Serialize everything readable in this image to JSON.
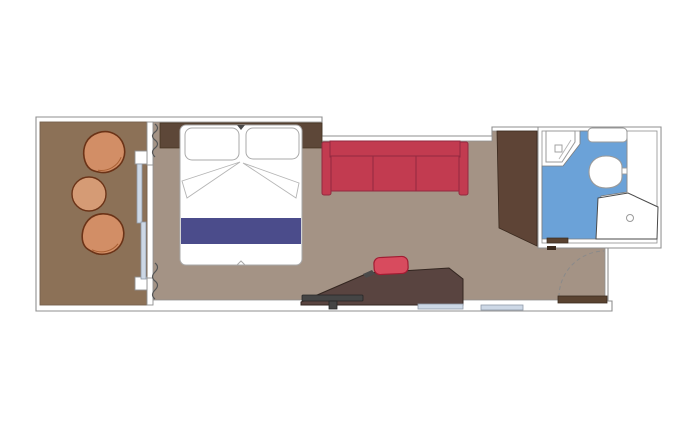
{
  "palette": {
    "background": "#ffffff",
    "wall_fill": "#ffffff",
    "wall_outline": "#8f8f8f",
    "balcony_floor": "#8c7157",
    "balcony_floor_edge": "#75604c",
    "room_floor": "#a49385",
    "floor_edge": "#8f8f8f",
    "chair": "#d28e66",
    "chair_outline": "#6b3317",
    "chair_rim": "#a85f33",
    "table": "#d59b75",
    "headboard_wood": "#5d4738",
    "headboard_edge": "#42311f",
    "wardrobe": "#5e4436",
    "wardrobe_outline": "#39291e",
    "bed_fill": "#ffffff",
    "bed_outline": "#a9a9a9",
    "fold_line": "#b5b5b5",
    "blanket_navy": "#4b4c8b",
    "sofa": "#c23b50",
    "sofa_outline": "#932940",
    "stool": "#d84b5e",
    "stool_outline": "#a11d33",
    "desk": "#594440",
    "desk_outline": "#332620",
    "tv": "#454545",
    "tv_outline": "#262626",
    "glass_panel": "#cdd8e6",
    "glass_outline": "#8f9aa8",
    "bath_floor": "#6ba2d8",
    "bath_floor_edge": "#7d7d7d",
    "fixture_fill": "#ffffff",
    "fixture_outline": "#9a9a9a",
    "door_wood": "#5a4331",
    "door_outline": "#3a2b1e",
    "sill_dark": "#3b2b1e",
    "drape": "#555555",
    "swing_arc": "#8a8a8a",
    "accent_mark": "#4a4a4a"
  },
  "floorplan": {
    "rooms": [
      {
        "name": "balcony",
        "furniture": [
          "armchair",
          "armchair",
          "round-table",
          "sliding-glass-door",
          "curtains"
        ]
      },
      {
        "name": "cabin",
        "furniture": [
          "double-bed",
          "headboard",
          "sofa",
          "wardrobe",
          "desk",
          "stool",
          "tv"
        ]
      },
      {
        "name": "bathroom",
        "furniture": [
          "sink",
          "shelf",
          "toilet",
          "shower"
        ]
      },
      {
        "name": "entry",
        "furniture": [
          "entry-door",
          "door-swing-arc"
        ]
      }
    ]
  }
}
